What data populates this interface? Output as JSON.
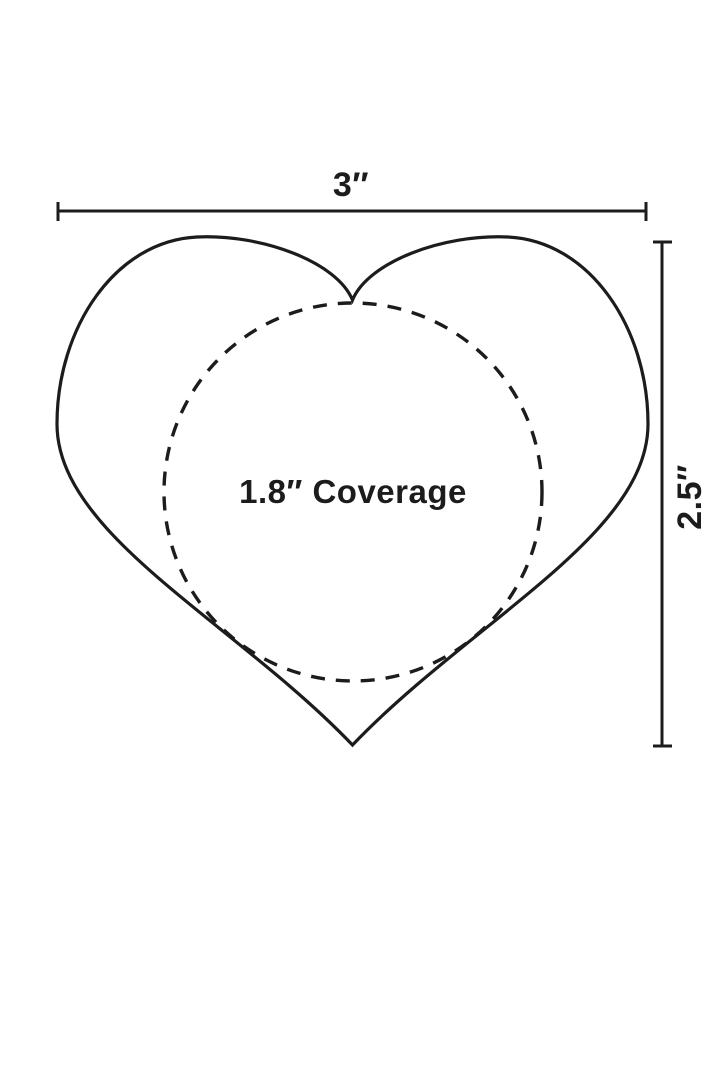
{
  "diagram": {
    "name": "heart-pasty-dimension-diagram",
    "width_label": "3″",
    "height_label": "2.5″",
    "coverage_label": "1.8″ Coverage"
  },
  "colors": {
    "ink": "#1c1c1c",
    "background": "#ffffff"
  }
}
